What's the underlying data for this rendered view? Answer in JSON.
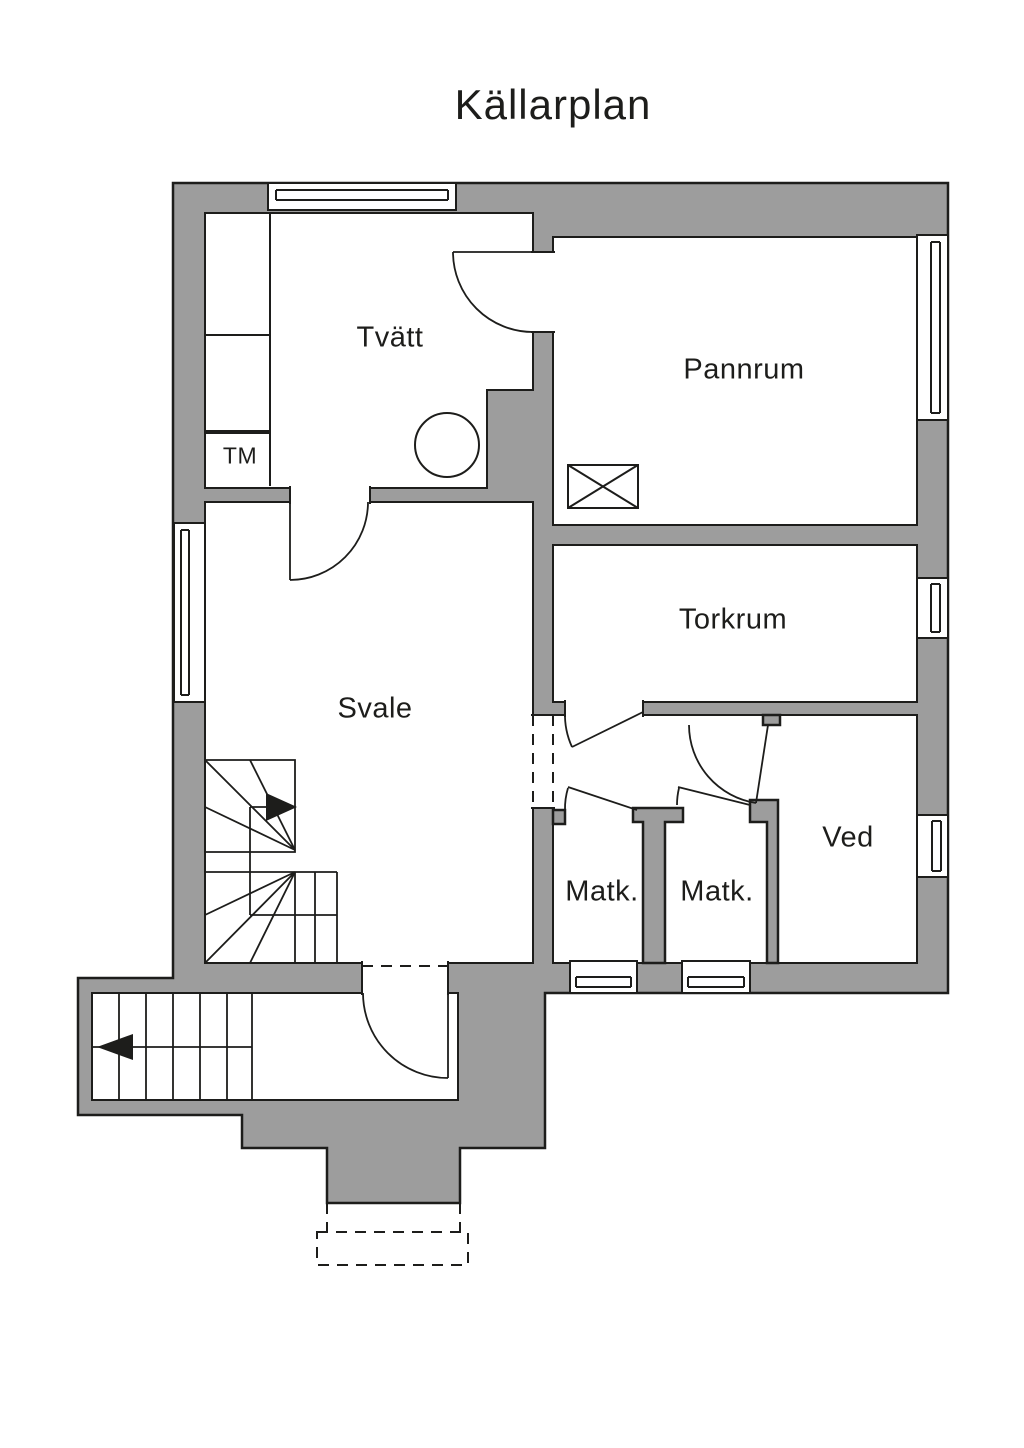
{
  "title": "Källarplan",
  "colors": {
    "wall": "#9d9d9d",
    "line": "#1d1d1b",
    "background": "#ffffff"
  },
  "rooms": [
    {
      "id": "tvatt",
      "label": "Tvätt"
    },
    {
      "id": "pannrum",
      "label": "Pannrum"
    },
    {
      "id": "torkrum",
      "label": "Torkrum"
    },
    {
      "id": "svale",
      "label": "Svale"
    },
    {
      "id": "matk-left",
      "label": "Matk."
    },
    {
      "id": "matk-right",
      "label": "Matk."
    },
    {
      "id": "ved",
      "label": "Ved"
    }
  ],
  "appliances": [
    {
      "id": "tm",
      "label": "TM"
    }
  ],
  "stairs": [
    {
      "id": "svale-stairs",
      "direction": "up",
      "arrow_icon": "right-arrow-icon"
    },
    {
      "id": "entry-stairs",
      "direction": "out",
      "arrow_icon": "left-arrow-icon"
    }
  ]
}
